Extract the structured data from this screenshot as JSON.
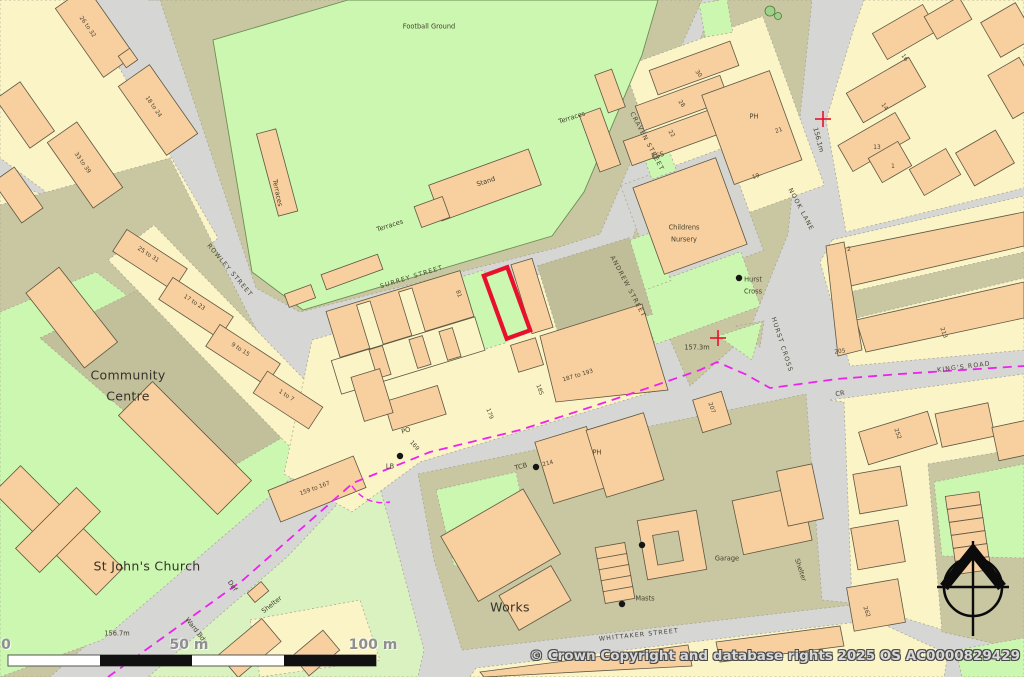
{
  "map": {
    "areas": {
      "football_ground": "Football Ground",
      "community_centre_l1": "Community",
      "community_centre_l2": "Centre",
      "st_johns_church": "St John's Church",
      "works": "Works",
      "childrens_nursery_l1": "Childrens",
      "childrens_nursery_l2": "Nursery",
      "hurst_cross_l1": "Hurst",
      "hurst_cross_l2": "Cross",
      "stand": "Stand",
      "terraces": "Terraces",
      "garage": "Garage",
      "masts": "Masts",
      "shelter": "Shelter"
    },
    "streets": {
      "surrey": "SURREY STREET",
      "craven": "CRAVEN STREET",
      "andrew": "ANDREW STREET",
      "rowley": "ROWLEY STREET",
      "nook_lane": "NOOK LANE",
      "hurst_cross": "HURST CROSS",
      "kings_road": "KING'S ROAD",
      "whittaker": "WHITTAKER STREET"
    },
    "poi": {
      "ph": "PH",
      "po": "PO",
      "lb": "LB",
      "tcb": "TCB",
      "ess": "ESS",
      "def": "Def",
      "ward_bdy": "Ward Bdy",
      "cr": "CR",
      "n214": "214"
    },
    "spot_heights": {
      "junction": "157.3m",
      "nook_lane": "156.1m",
      "church": "156.7m"
    },
    "house_numbers": {
      "r26_32": "26 to 32",
      "r18_24": "18 to 24",
      "r33_39": "33 to 39",
      "r25_31": "25 to 31",
      "r17_23": "17 to 23",
      "r9_15": "9 to 15",
      "r1_7": "1 to 7",
      "r159_167": "159 to 167",
      "r187_193": "187 to 193",
      "n81": "81",
      "n185": "185",
      "n179": "179",
      "n169": "169",
      "n205": "205",
      "n213": "213",
      "n2": "2",
      "n252": "252",
      "n262": "262",
      "n207": "207",
      "n16": "16",
      "n14": "14",
      "n13": "13",
      "n1": "1",
      "n30": "30",
      "n28": "28",
      "n22": "22",
      "n21": "21",
      "n19": "19"
    },
    "scale_bar": {
      "zero": "0",
      "fifty": "50 m",
      "hundred": "100 m"
    },
    "copyright": "© Crown Copyright and database rights 2025 OS AC0000829429",
    "colors": {
      "plot_outline": "#e8112d",
      "boundary_line": "#ee22ee",
      "building": "#f8cf9e",
      "parcel": "#faf4c6",
      "green_space": "#cbf7b0",
      "road": "#d6d6d4",
      "verge": "#c9c7a2"
    }
  }
}
